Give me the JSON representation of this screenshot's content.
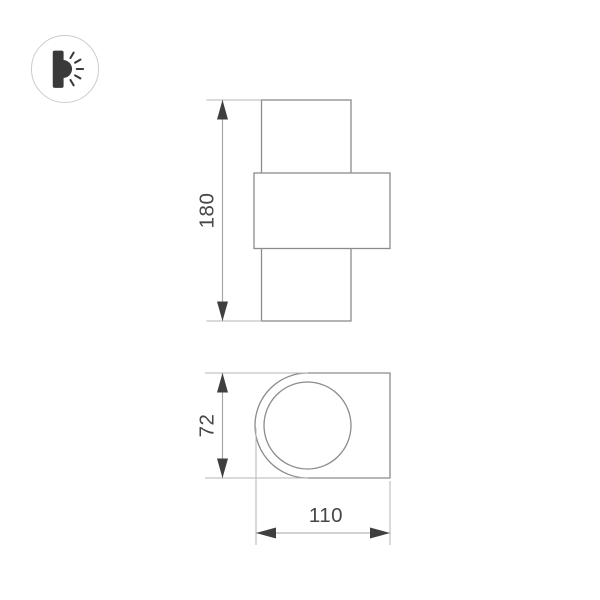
{
  "window": {
    "background": "#ffffff"
  },
  "badge": {
    "icon": "wall-light-icon",
    "border_color": "#cccccc",
    "glyph_color": "#3a3a3a"
  },
  "drawing": {
    "front_view": {
      "height_label": "180"
    },
    "side_view": {
      "height_label": "72",
      "width_label": "110"
    },
    "colors": {
      "outline": "#8c8c8c",
      "dimension_line": "#a3a3a3",
      "extension_line": "#b6b6b6",
      "arrow": "#3f3f3f",
      "label_text": "#474747"
    }
  }
}
